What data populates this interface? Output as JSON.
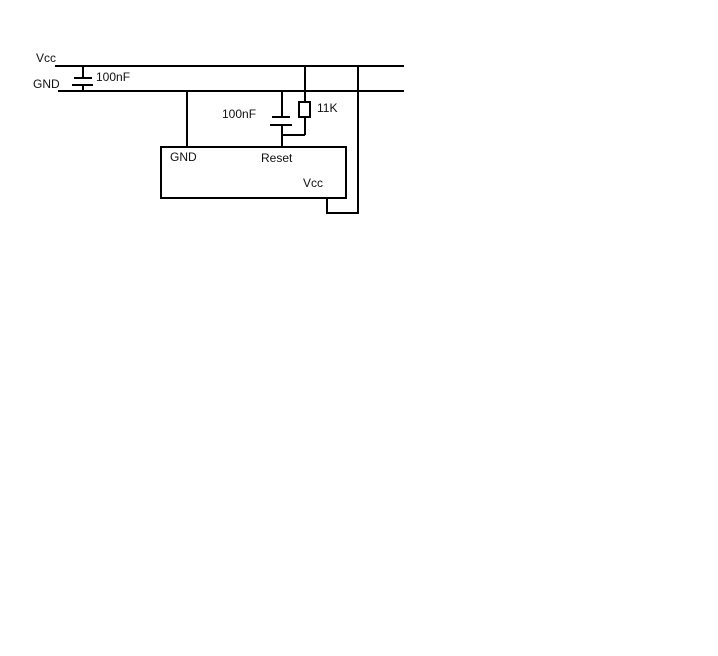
{
  "canvas": {
    "background_color": "#ffffff",
    "line_color": "#000000",
    "text_color": "#000000"
  },
  "rails": {
    "vcc_label": "Vcc",
    "gnd_label": "GND"
  },
  "components": {
    "decoupling_capacitor": {
      "value": "100nF"
    },
    "reset_capacitor": {
      "value": "100nF"
    },
    "pullup_resistor": {
      "value": "11K"
    }
  },
  "ic": {
    "pin_gnd_label": "GND",
    "pin_reset_label": "Reset",
    "pin_vcc_label": "Vcc"
  }
}
